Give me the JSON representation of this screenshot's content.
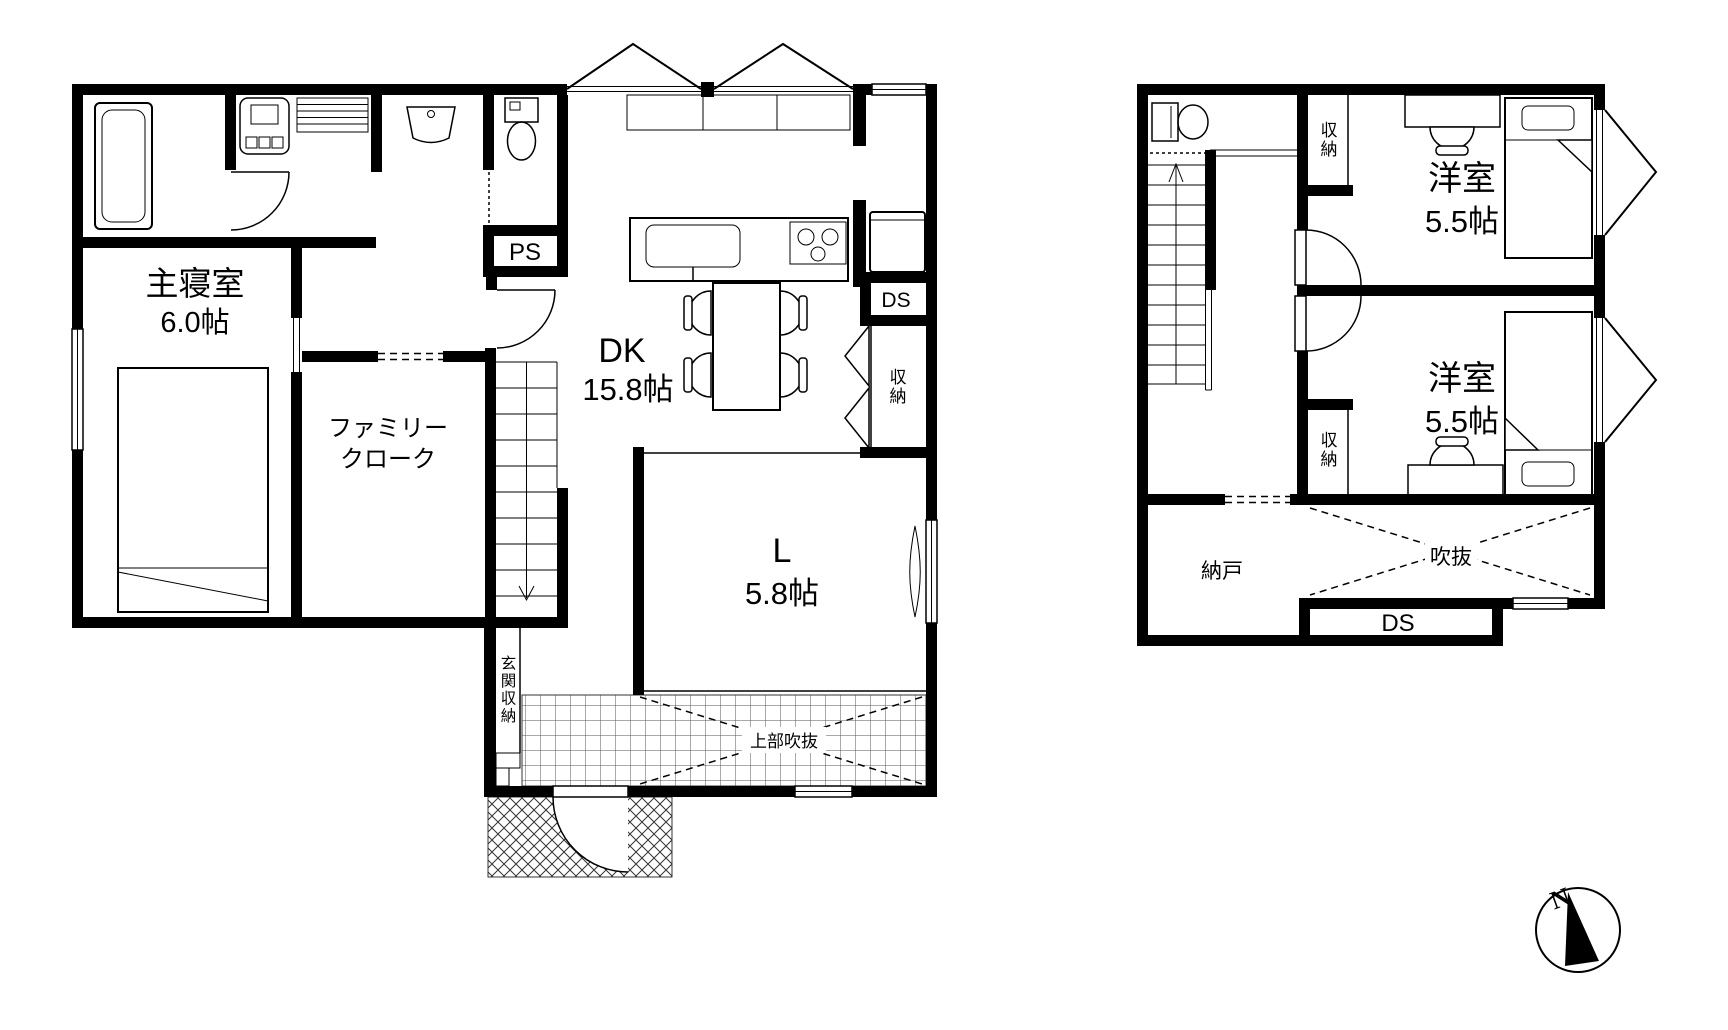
{
  "plan": {
    "floor1": {
      "master_bedroom_name": "主寝室",
      "master_bedroom_size": "6.0帖",
      "family_closet_line1": "ファミリー",
      "family_closet_line2": "クローク",
      "dk_name": "DK",
      "dk_size": "15.8帖",
      "living_name": "L",
      "living_size": "5.8帖",
      "pipe_space": "PS",
      "duct_space": "DS",
      "closet": "収納",
      "entrance_storage": "玄関収納",
      "upper_void": "上部吹抜"
    },
    "floor2": {
      "room1_name": "洋室",
      "room1_size": "5.5帖",
      "room2_name": "洋室",
      "room2_size": "5.5帖",
      "closet1": "収納",
      "closet2": "収納",
      "storeroom": "納戸",
      "void": "吹抜",
      "duct_space": "DS"
    },
    "compass_north": "N",
    "colors": {
      "wall": "#000000",
      "background": "#ffffff",
      "hatch": "#444444"
    }
  }
}
